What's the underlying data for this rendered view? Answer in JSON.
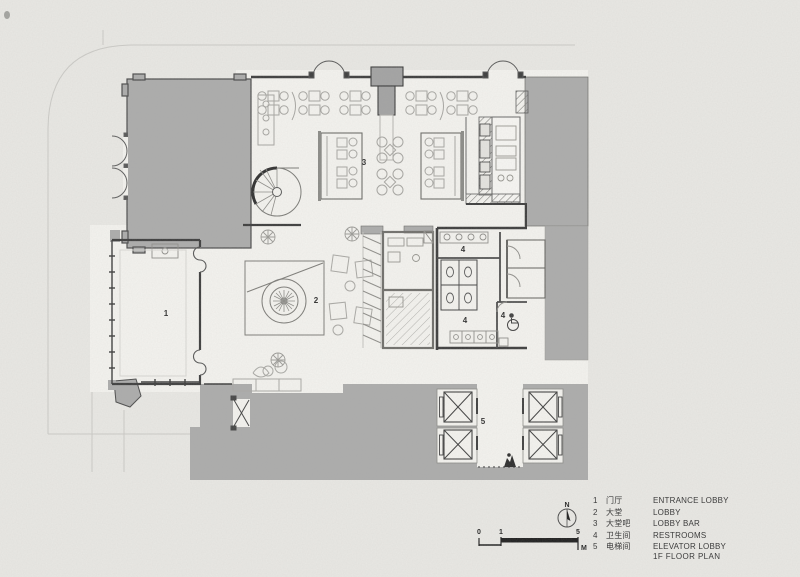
{
  "drawing": {
    "title": "1F FLOOR PLAN",
    "legend": [
      {
        "num": "1",
        "zh": "门厅",
        "en": "ENTRANCE LOBBY"
      },
      {
        "num": "2",
        "zh": "大堂",
        "en": "LOBBY"
      },
      {
        "num": "3",
        "zh": "大堂吧",
        "en": "LOBBY BAR"
      },
      {
        "num": "4",
        "zh": "卫生间",
        "en": "RESTROOMS"
      },
      {
        "num": "5",
        "zh": "电梯间",
        "en": "ELEVATOR LOBBY"
      }
    ],
    "room_labels": {
      "entrance_lobby": "1",
      "lobby": "2",
      "lobby_bar": "3",
      "restroom_top": "4",
      "restroom_bottom": "4",
      "restroom_accessible": "4",
      "elevator_lobby": "5"
    },
    "north_label": "N",
    "scale_bar": {
      "zero": "0",
      "one": "1",
      "five": "5",
      "unit": "M"
    },
    "colors": {
      "paper": "#e9e8e4",
      "poche_gray": "#ababab",
      "floor_white": "#f4f3ef",
      "wall_dark": "#3c3c3c",
      "furniture_line": "#a6a5a1",
      "text": "#3c3c3c"
    }
  }
}
